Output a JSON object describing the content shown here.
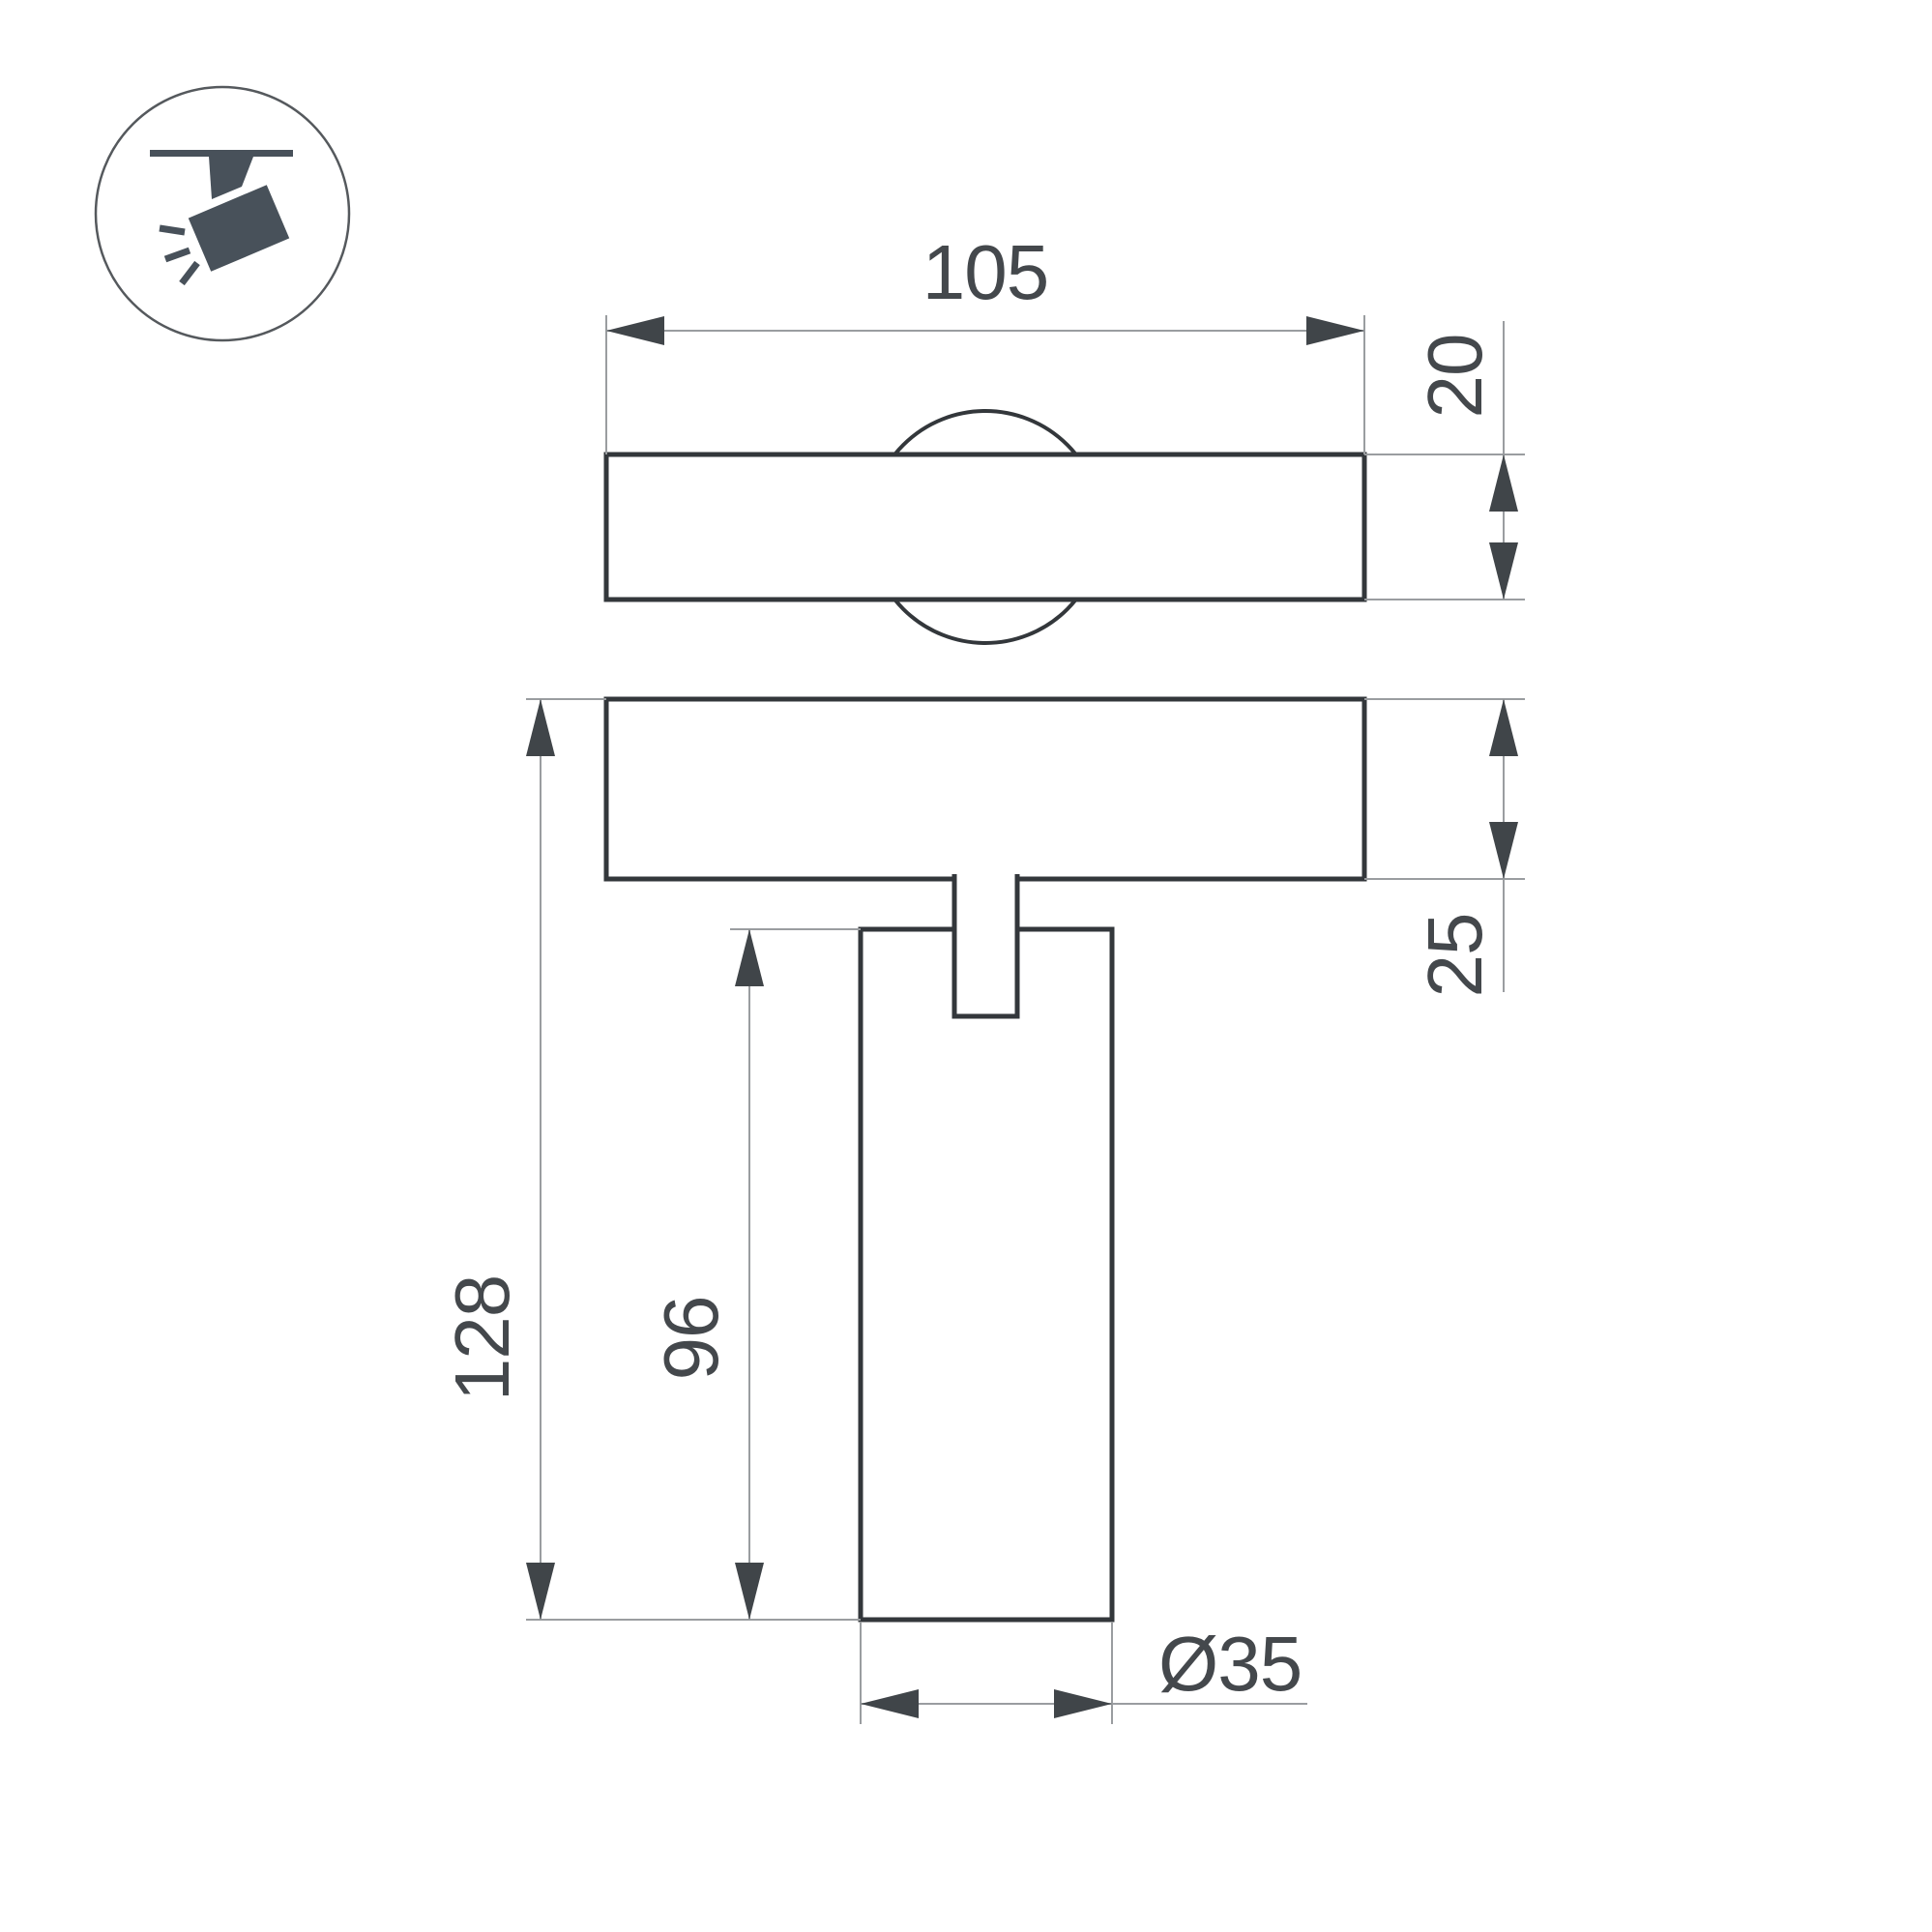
{
  "drawing": {
    "title": "track spotlight dimensional drawing",
    "icon": {
      "name": "track-spotlight-icon"
    },
    "dimensions": {
      "d105": {
        "label": "105"
      },
      "d20": {
        "label": "20"
      },
      "d25": {
        "label": "25"
      },
      "d128": {
        "label": "128"
      },
      "d96": {
        "label": "96"
      },
      "d35": {
        "label": "Ø35"
      }
    },
    "colors": {
      "background": "#ffffff",
      "object_outline": "#33373b",
      "dimension_line": "#9a9da0",
      "dimension_text": "#44484c",
      "icon_fill": "#48515a"
    }
  }
}
